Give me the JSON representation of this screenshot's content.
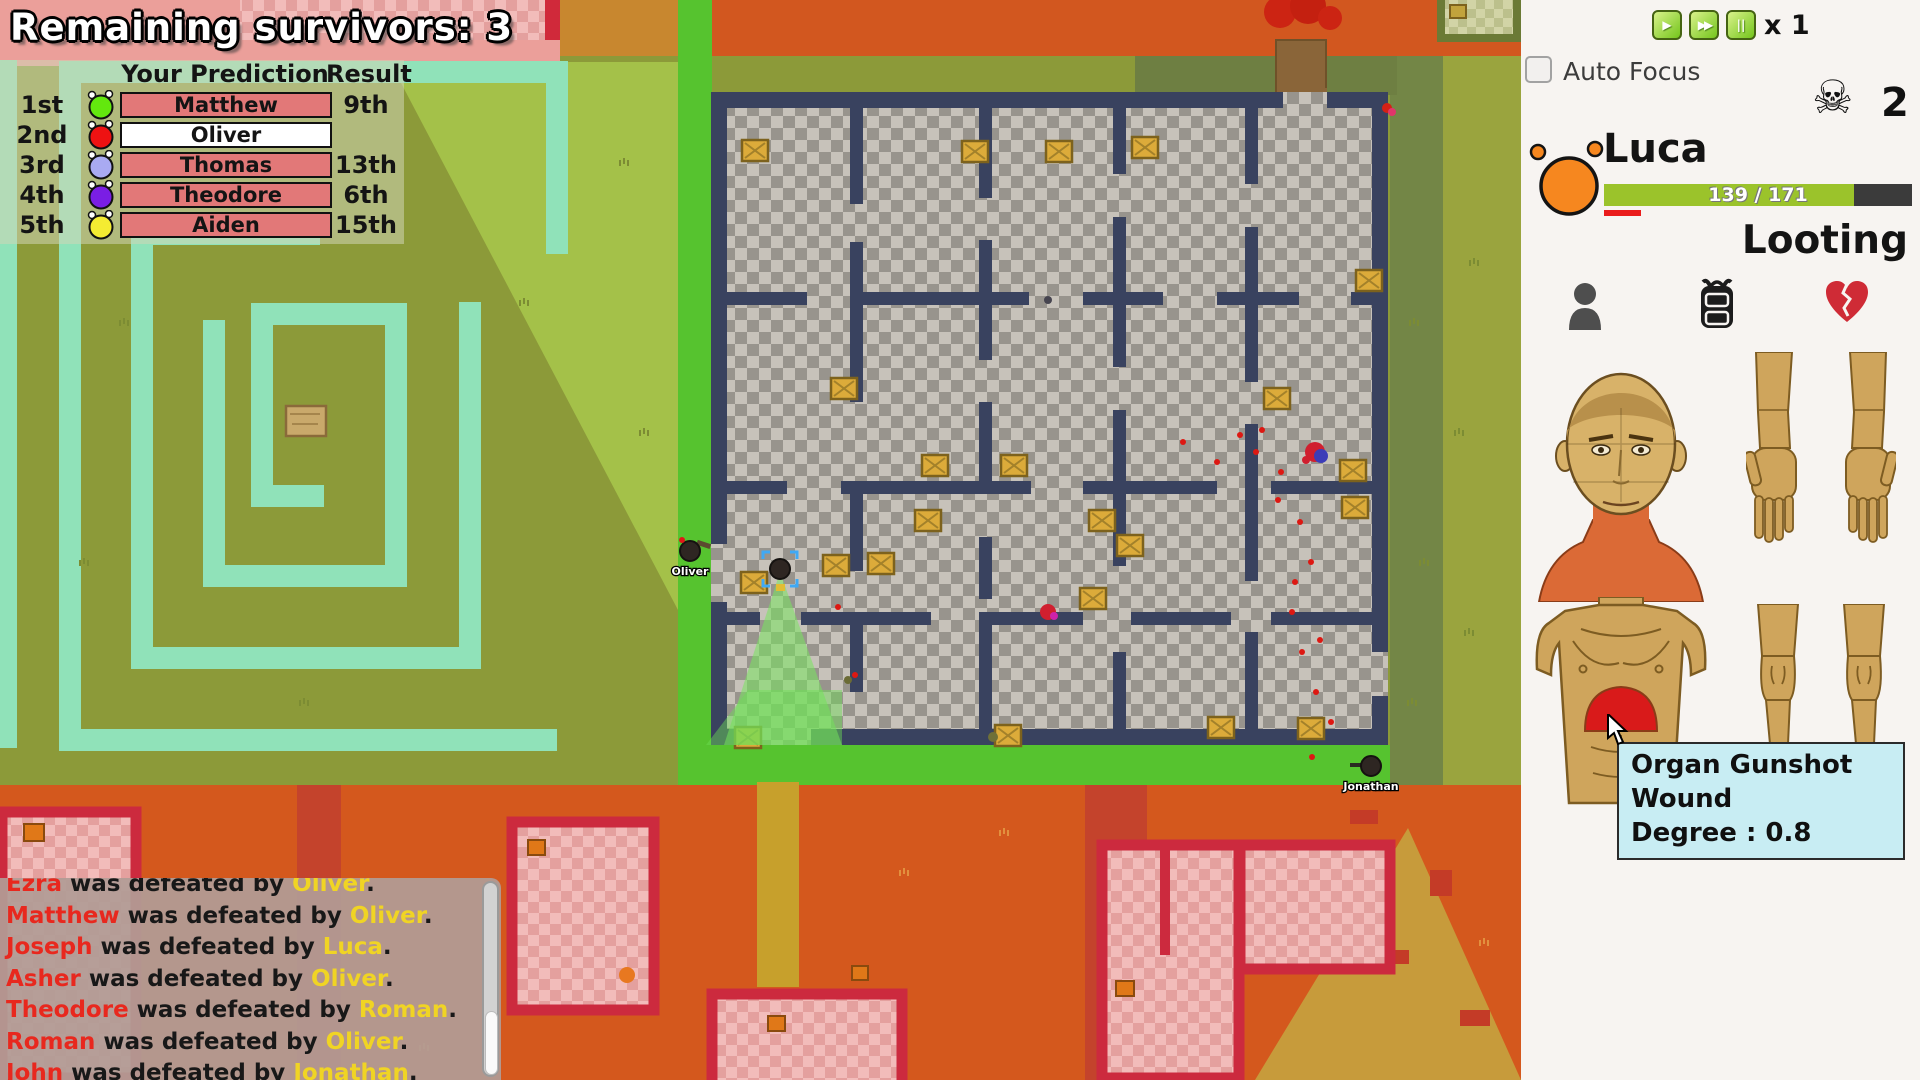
{
  "title": {
    "text": "Remaining survivors: 3"
  },
  "prediction": {
    "header_prediction": "Your Prediction",
    "header_result": "Result",
    "row_bg": "#e27878",
    "row_bg_highlight": "#ffffff",
    "rows": [
      {
        "rank": "1st",
        "name": "Matthew",
        "result": "9th",
        "color": "#63e80e",
        "highlight": false
      },
      {
        "rank": "2nd",
        "name": "Oliver",
        "result": "",
        "color": "#ee1212",
        "highlight": true
      },
      {
        "rank": "3rd",
        "name": "Thomas",
        "result": "13th",
        "color": "#a9aaf2",
        "highlight": false
      },
      {
        "rank": "4th",
        "name": "Theodore",
        "result": "6th",
        "color": "#7a1ee4",
        "highlight": false
      },
      {
        "rank": "5th",
        "name": "Aiden",
        "result": "15th",
        "color": "#f4ec32",
        "highlight": false
      }
    ]
  },
  "kill_feed": {
    "middle": " was defeated by ",
    "period": ".",
    "colors": {
      "victim": "#e8281e",
      "killer": "#f0d424",
      "text": "#181818"
    },
    "entries": [
      {
        "victim": "Ezra",
        "killer": "Oliver"
      },
      {
        "victim": "Matthew",
        "killer": "Oliver"
      },
      {
        "victim": "Joseph",
        "killer": "Luca"
      },
      {
        "victim": "Asher",
        "killer": "Oliver"
      },
      {
        "victim": "Theodore",
        "killer": "Roman"
      },
      {
        "victim": "Roman",
        "killer": "Oliver"
      },
      {
        "victim": "John",
        "killer": "Jonathan"
      }
    ]
  },
  "sidebar": {
    "speed": {
      "multiplier": "x 1",
      "buttons": [
        {
          "name": "play-button",
          "glyph": "▶"
        },
        {
          "name": "fast-forward-button",
          "glyph": "▶▶"
        },
        {
          "name": "pause-button",
          "glyph": "||"
        }
      ]
    },
    "auto_focus_label": "Auto Focus",
    "kill_count": "2",
    "character": {
      "name": "Luca",
      "hp_current": 139,
      "hp_max": 171,
      "hp_text": "139 / 171",
      "hp_color": "#9bc32b",
      "status": "Looting"
    },
    "tooltip": {
      "line1": "Organ Gunshot Wound",
      "line2": "Degree : 0.8"
    }
  },
  "map": {
    "characters": [
      {
        "label": "Oliver",
        "x": 690,
        "y": 551,
        "selected": false,
        "gun": "right"
      },
      {
        "label": "",
        "x": 780,
        "y": 569,
        "selected": true,
        "gun": "down"
      },
      {
        "label": "Jonathan",
        "x": 1371,
        "y": 766,
        "selected": false,
        "gun": "left"
      }
    ],
    "crates": [
      [
        742,
        140
      ],
      [
        962,
        141
      ],
      [
        1046,
        141
      ],
      [
        1132,
        137
      ],
      [
        1356,
        270
      ],
      [
        831,
        378
      ],
      [
        1264,
        388
      ],
      [
        922,
        455
      ],
      [
        1001,
        455
      ],
      [
        1340,
        460
      ],
      [
        1342,
        497
      ],
      [
        1117,
        535
      ],
      [
        915,
        510
      ],
      [
        1089,
        510
      ],
      [
        741,
        572
      ],
      [
        823,
        555
      ],
      [
        868,
        553
      ],
      [
        1080,
        588
      ],
      [
        735,
        727
      ],
      [
        995,
        725
      ],
      [
        1208,
        717
      ],
      [
        1298,
        718
      ]
    ],
    "blood_dots": [
      [
        1240,
        435
      ],
      [
        1256,
        452
      ],
      [
        1281,
        472
      ],
      [
        1300,
        522
      ],
      [
        1311,
        562
      ],
      [
        1292,
        612
      ],
      [
        1302,
        652
      ],
      [
        1316,
        692
      ],
      [
        1331,
        722
      ],
      [
        1312,
        757
      ],
      [
        855,
        675
      ],
      [
        838,
        607
      ],
      [
        1183,
        442
      ],
      [
        1217,
        462
      ],
      [
        1262,
        430
      ],
      [
        1278,
        500
      ],
      [
        1295,
        582
      ],
      [
        1320,
        640
      ]
    ],
    "tufts_olive": [
      [
        120,
        320
      ],
      [
        80,
        560
      ],
      [
        300,
        700
      ],
      [
        520,
        300
      ],
      [
        640,
        430
      ],
      [
        1410,
        320
      ],
      [
        1420,
        560
      ],
      [
        1408,
        700
      ],
      [
        1470,
        260
      ],
      [
        1465,
        630
      ],
      [
        620,
        160
      ],
      [
        1455,
        430
      ]
    ],
    "tufts_orange": [
      [
        640,
        835
      ],
      [
        560,
        960
      ],
      [
        1000,
        830
      ],
      [
        1330,
        900
      ],
      [
        1180,
        1000
      ],
      [
        420,
        1045
      ],
      [
        900,
        870
      ],
      [
        1480,
        940
      ]
    ]
  }
}
